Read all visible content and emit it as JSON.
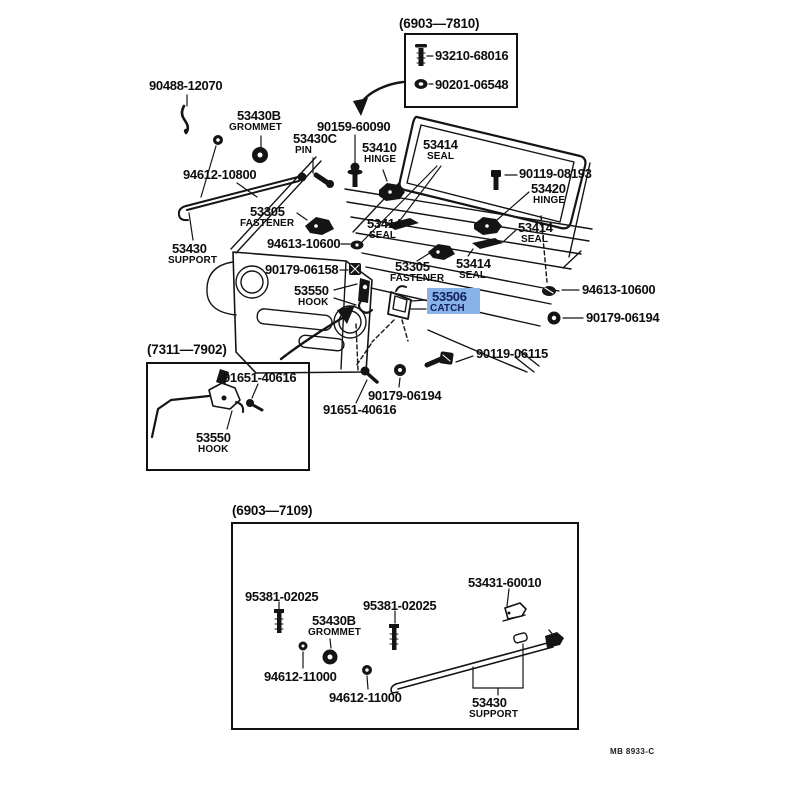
{
  "page": {
    "footer_code": "MB 8933-C",
    "highlight_color": "#87b3e9",
    "line_color": "#141414",
    "background": "#ffffff"
  },
  "inset_top": {
    "title": "(6903—7810)",
    "items": [
      {
        "number": "93210-68016",
        "icon": "screw-icon"
      },
      {
        "number": "90201-06548",
        "icon": "grommet-icon"
      }
    ]
  },
  "inset_left": {
    "title": "(7311—7902)",
    "items": [
      {
        "number": "91651-40616",
        "icon": "bolt-icon"
      },
      {
        "number": "53550",
        "name": "HOOK",
        "icon": "hook-icon"
      }
    ]
  },
  "inset_bottom": {
    "title": "(6903—7109)",
    "items": [
      {
        "number": "95381-02025",
        "icon": "screw-icon"
      },
      {
        "number": "95381-02025",
        "icon": "screw-icon"
      },
      {
        "number": "53430B",
        "name": "GROMMET",
        "icon": "grommet-icon"
      },
      {
        "number": "53431-60010",
        "icon": "bracket-icon"
      },
      {
        "number": "94612-11000",
        "icon": "grommet-icon"
      },
      {
        "number": "94612-11000",
        "icon": "grommet-icon"
      },
      {
        "number": "53430",
        "name": "SUPPORT",
        "icon": "support-rod-icon"
      }
    ]
  },
  "callouts": [
    {
      "number": "90488-12070",
      "icon": "clip-icon"
    },
    {
      "number": "53430B",
      "name": "GROMMET",
      "icon": "grommet-icon"
    },
    {
      "number": "90159-60090",
      "icon": "screw-washer-icon"
    },
    {
      "number": "53430C",
      "name": "PIN",
      "icon": "pin-icon"
    },
    {
      "number": "53410",
      "name": "HINGE",
      "icon": "hinge-icon"
    },
    {
      "number": "53414",
      "name": "SEAL",
      "icon": "seal-icon"
    },
    {
      "number": "90119-08193",
      "icon": "bolt-icon"
    },
    {
      "number": "53420",
      "name": "HINGE",
      "icon": "hinge-icon"
    },
    {
      "number": "53414",
      "name": "SEAL",
      "icon": "seal-icon"
    },
    {
      "number": "94612-10800",
      "icon": "support-rod-icon"
    },
    {
      "number": "53305",
      "name": "FASTENER",
      "icon": "fastener-icon"
    },
    {
      "number": "53414",
      "name": "SEAL",
      "icon": "seal-icon"
    },
    {
      "number": "53430",
      "name": "SUPPORT",
      "icon": "support-rod-icon"
    },
    {
      "number": "94613-10600",
      "icon": "grommet-icon"
    },
    {
      "number": "90179-06158",
      "icon": "nut-icon"
    },
    {
      "number": "53305",
      "name": "FASTENER",
      "icon": "fastener-icon"
    },
    {
      "number": "53414",
      "name": "SEAL",
      "icon": "seal-icon"
    },
    {
      "number": "53550",
      "name": "HOOK",
      "icon": "hook-icon"
    },
    {
      "number": "53506",
      "name": "CATCH",
      "icon": "catch-icon",
      "highlighted": true
    },
    {
      "number": "94613-10600",
      "icon": "grommet-icon"
    },
    {
      "number": "90179-06194",
      "icon": "nut-icon"
    },
    {
      "number": "90119-06115",
      "icon": "bolt-icon"
    },
    {
      "number": "90179-06194",
      "icon": "nut-icon"
    },
    {
      "number": "91651-40616",
      "icon": "bolt-icon"
    }
  ]
}
